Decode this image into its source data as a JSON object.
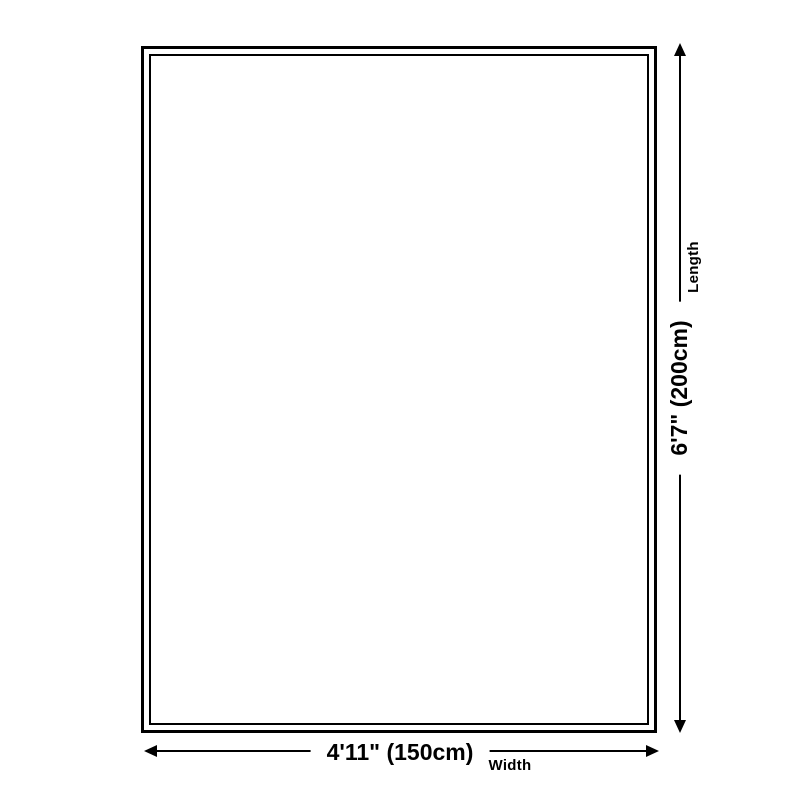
{
  "diagram": {
    "type": "size-dimension-diagram",
    "vertical_dimension": {
      "value": "6'7\" (200cm)",
      "label": "Length"
    },
    "horizontal_dimension": {
      "value": "4'11\" (150cm)",
      "label": "Width"
    }
  },
  "colors": {
    "line": "#000000",
    "text": "#000000",
    "background": "#ffffff"
  }
}
